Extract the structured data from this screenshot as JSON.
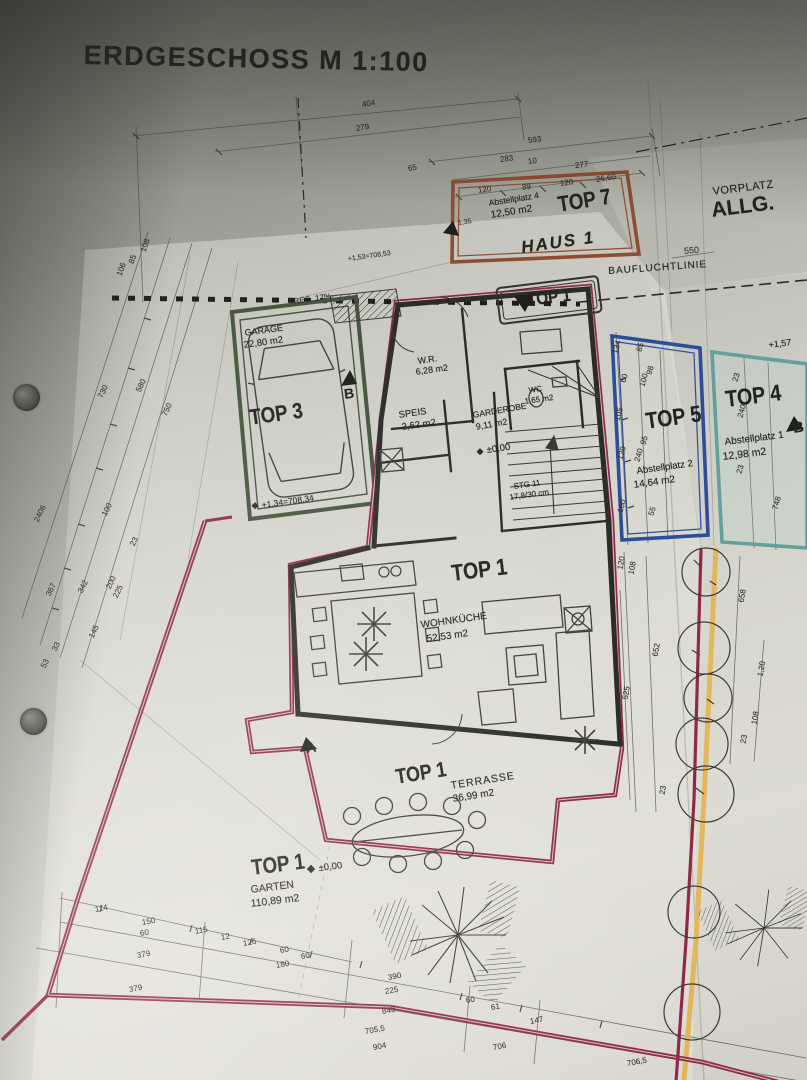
{
  "title": "ERDGESCHOSS M 1:100",
  "vorplatz": {
    "line1": "VORPLATZ",
    "line2": "ALLG."
  },
  "bauflucht": {
    "label": "BAUFLUCHTLINIE"
  },
  "haus": {
    "label": "HAUS 1"
  },
  "tops": {
    "top7": {
      "name": "TOP 7",
      "room": "Abstellplatz 4",
      "area": "12,50 m2"
    },
    "top5": {
      "name": "TOP 5",
      "room": "Abstellplatz 2",
      "area": "14,64 m2"
    },
    "top4": {
      "name": "TOP 4",
      "room": "Abstellplatz 1",
      "area": "12,98 m2",
      "level": "+1,57"
    },
    "top3": {
      "name": "TOP 3",
      "room": "GARAGE",
      "area": "22,80 m2",
      "level": "+1,34=708,34",
      "ramp": "REG. 17%"
    },
    "top1": {
      "name": "TOP 1"
    },
    "top1_main": {
      "name": "TOP 1",
      "room": "WOHNKÜCHE",
      "area": "52,53 m2"
    },
    "top1_terrasse": {
      "name": "TOP 1",
      "room": "TERRASSE",
      "area": "36,99 m2"
    },
    "top1_garten": {
      "name": "TOP 1",
      "room": "GARTEN",
      "area": "110,89 m2",
      "level": "±0,00"
    }
  },
  "rooms": {
    "wr": {
      "name": "W.R.",
      "area": "6,28 m2"
    },
    "speis": {
      "name": "SPEIS",
      "area": "2,62 m2"
    },
    "garderobe": {
      "name": "GARDEROBE",
      "area": "9,11 m2",
      "level": "±0,00"
    },
    "wc": {
      "name": "WC",
      "area": "1,65 m2"
    },
    "stairs": {
      "name": "STG 11",
      "detail": "17,8/30 cm"
    }
  },
  "markers": {
    "a": "A",
    "b": "B"
  },
  "colors": {
    "boundary": "#8e2946",
    "top7": "#8f4c33",
    "garage": "#44543b",
    "top5": "#2d4d96",
    "top4": "#63a09b",
    "yellow": "#e3b451"
  },
  "dims": [
    "404",
    "279",
    "593",
    "283",
    "10",
    "277",
    "65",
    "120",
    "89",
    "120",
    "26,60",
    "550",
    "108",
    "85",
    "106",
    "730",
    "580",
    "750",
    "2406",
    "100",
    "23",
    "367",
    "342",
    "200",
    "225",
    "145",
    "33",
    "53",
    "134",
    "85",
    "60",
    "100",
    "98",
    "105",
    "120",
    "240",
    "95",
    "160",
    "55",
    "23",
    "240",
    "23",
    "748",
    "120",
    "108",
    "652",
    "525",
    "658",
    "1,20",
    "108",
    "23",
    "23",
    "114",
    "150",
    "60",
    "115",
    "12",
    "126",
    "60",
    "60",
    "180",
    "379",
    "379",
    "390",
    "225",
    "843",
    "60",
    "61",
    "147",
    "705,5",
    "904",
    "706",
    "706,5",
    "+1,53=708,53",
    "1,35"
  ]
}
